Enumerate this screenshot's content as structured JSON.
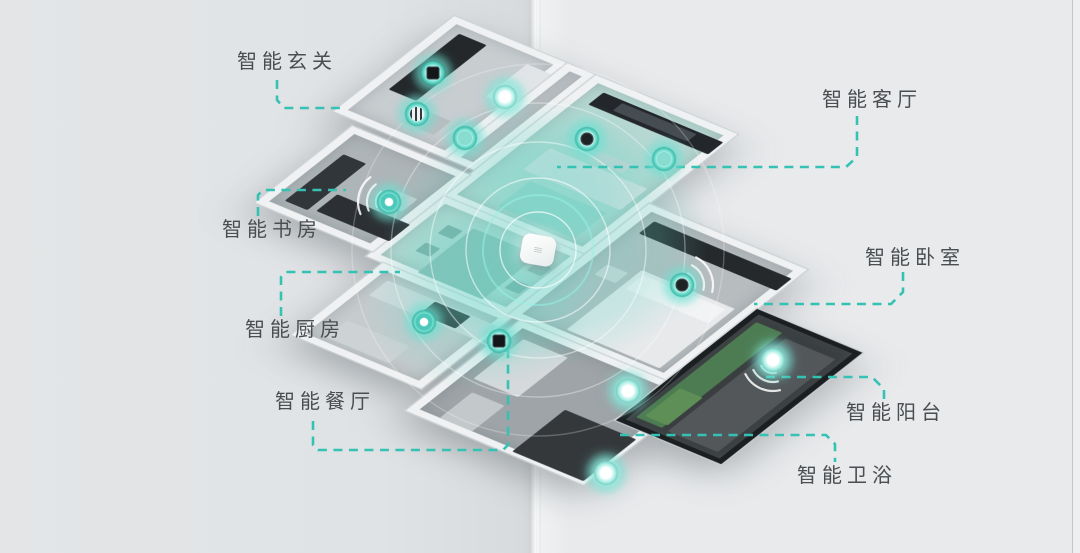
{
  "background": {
    "page_left_color": "#e0e3e5",
    "page_right_color": "#e8eaec",
    "fold_x": 537,
    "edge_line_x": 1072
  },
  "palette": {
    "leader_teal": "#35c2b4",
    "device_glow": "#6fdccd",
    "label_text": "#4a4e51",
    "wall": "#eff1f2"
  },
  "labels": [
    {
      "id": "entry",
      "text": "智能玄关",
      "x": 237,
      "y": 52
    },
    {
      "id": "study",
      "text": "智能书房",
      "x": 222,
      "y": 220
    },
    {
      "id": "kitchen",
      "text": "智能厨房",
      "x": 245,
      "y": 320
    },
    {
      "id": "dining",
      "text": "智能餐厅",
      "x": 275,
      "y": 392
    },
    {
      "id": "living",
      "text": "智能客厅",
      "x": 822,
      "y": 90
    },
    {
      "id": "bedroom",
      "text": "智能卧室",
      "x": 865,
      "y": 248
    },
    {
      "id": "balcony",
      "text": "智能阳台",
      "x": 846,
      "y": 403
    },
    {
      "id": "bathroom",
      "text": "智能卫浴",
      "x": 797,
      "y": 466
    }
  ],
  "leaders": [
    {
      "for": "entry",
      "points": [
        [
          277,
          80
        ],
        [
          277,
          100
        ],
        [
          284,
          108
        ],
        [
          342,
          108
        ]
      ]
    },
    {
      "for": "study",
      "points": [
        [
          258,
          216
        ],
        [
          258,
          195
        ],
        [
          263,
          190
        ],
        [
          346,
          190
        ]
      ]
    },
    {
      "for": "kitchen",
      "points": [
        [
          281,
          316
        ],
        [
          281,
          277
        ],
        [
          286,
          272
        ],
        [
          400,
          272
        ]
      ]
    },
    {
      "for": "dining",
      "points": [
        [
          313,
          421
        ],
        [
          313,
          445
        ],
        [
          318,
          450
        ],
        [
          503,
          450
        ],
        [
          508,
          445
        ],
        [
          508,
          346
        ]
      ]
    },
    {
      "for": "living",
      "points": [
        [
          857,
          116
        ],
        [
          857,
          157
        ],
        [
          846,
          167
        ],
        [
          557,
          167
        ]
      ]
    },
    {
      "for": "bedroom",
      "points": [
        [
          903,
          272
        ],
        [
          903,
          292
        ],
        [
          891,
          304
        ],
        [
          754,
          304
        ]
      ]
    },
    {
      "for": "balcony",
      "points": [
        [
          766,
          377
        ],
        [
          872,
          377
        ],
        [
          884,
          389
        ],
        [
          884,
          401
        ]
      ]
    },
    {
      "for": "bathroom",
      "points": [
        [
          620,
          435
        ],
        [
          826,
          435
        ],
        [
          835,
          444
        ],
        [
          835,
          462
        ]
      ]
    }
  ],
  "devices": [
    {
      "id": "entry-wall-panel",
      "x": 433,
      "y": 73,
      "variant": "panel"
    },
    {
      "id": "entry-ceiling-light",
      "x": 505,
      "y": 97,
      "variant": "bright"
    },
    {
      "id": "entry-controller",
      "x": 417,
      "y": 114,
      "variant": "striped"
    },
    {
      "id": "hallway-sensor",
      "x": 465,
      "y": 138,
      "variant": "teal"
    },
    {
      "id": "living-tv-device",
      "x": 587,
      "y": 139,
      "variant": "dark"
    },
    {
      "id": "living-wall-device",
      "x": 664,
      "y": 159,
      "variant": "teal"
    },
    {
      "id": "study-speaker",
      "x": 389,
      "y": 202,
      "variant": "ring"
    },
    {
      "id": "kitchen-sensor",
      "x": 424,
      "y": 322,
      "variant": "ring"
    },
    {
      "id": "dining-wall-panel",
      "x": 499,
      "y": 341,
      "variant": "panel"
    },
    {
      "id": "bedroom-speaker",
      "x": 682,
      "y": 285,
      "variant": "dark"
    },
    {
      "id": "bathroom-sensor-1",
      "x": 628,
      "y": 391,
      "variant": "bright"
    },
    {
      "id": "bathroom-sensor-2",
      "x": 606,
      "y": 473,
      "variant": "bright"
    },
    {
      "id": "balcony-sensor",
      "x": 773,
      "y": 360,
      "variant": "bright"
    }
  ],
  "hub": {
    "x": 538,
    "y": 250,
    "rings": [
      38,
      72,
      108,
      147,
      186
    ],
    "teal_ring": 55
  },
  "wifi": [
    {
      "at": "study",
      "x": 389,
      "y": 202,
      "dir": 195
    },
    {
      "at": "bedroom",
      "x": 682,
      "y": 285,
      "dir": 335
    },
    {
      "at": "balcony",
      "x": 773,
      "y": 360,
      "dir": 115
    }
  ],
  "glows": [
    {
      "x": 545,
      "y": 242,
      "rx": 210,
      "ry": 160,
      "o": 0.4
    },
    {
      "x": 478,
      "y": 300,
      "rx": 150,
      "ry": 115,
      "o": 0.28
    },
    {
      "x": 560,
      "y": 170,
      "rx": 120,
      "ry": 92,
      "o": 0.24
    }
  ],
  "floorplan": {
    "origin": {
      "left": 430,
      "top": 6
    },
    "rooms": [
      {
        "id": "entry",
        "x": 30,
        "y": 0,
        "w": 140,
        "h": 205,
        "floor": "#c8cdd0",
        "furniture": [
          [
            12,
            12,
            34,
            120,
            "#24282b"
          ],
          [
            98,
            15,
            52,
            70,
            "#e2e5e7"
          ],
          [
            55,
            140,
            40,
            30,
            "#b8bec1"
          ]
        ]
      },
      {
        "id": "hallway",
        "x": 170,
        "y": 0,
        "w": 35,
        "h": 205,
        "floor": "#c2c7ca",
        "furniture": []
      },
      {
        "id": "living",
        "x": 205,
        "y": 0,
        "w": 175,
        "h": 260,
        "floor": "#b7d8d2",
        "furniture": [
          [
            14,
            10,
            148,
            26,
            "#23272b"
          ],
          [
            40,
            14,
            92,
            16,
            "#454c52"
          ],
          [
            28,
            120,
            120,
            46,
            "#dde0e2"
          ],
          [
            45,
            178,
            95,
            55,
            "rgba(120,200,190,.38)"
          ],
          [
            70,
            95,
            42,
            18,
            "#cfd4d6"
          ]
        ]
      },
      {
        "id": "dining",
        "x": 205,
        "y": 260,
        "w": 175,
        "h": 130,
        "floor": "#b9d8d2",
        "furniture": [
          [
            48,
            18,
            80,
            95,
            "#8fbab3"
          ],
          [
            24,
            28,
            18,
            18,
            "#7fa9a3"
          ],
          [
            24,
            66,
            18,
            18,
            "#7fa9a3"
          ],
          [
            134,
            28,
            18,
            18,
            "#7fa9a3"
          ],
          [
            134,
            66,
            18,
            18,
            "#7fa9a3"
          ]
        ]
      },
      {
        "id": "study",
        "x": 60,
        "y": 215,
        "w": 145,
        "h": 165,
        "floor": "#aeb5b8",
        "furniture": [
          [
            12,
            35,
            28,
            100,
            "#31363a"
          ],
          [
            48,
            95,
            90,
            36,
            "#2c3034"
          ],
          [
            92,
            55,
            26,
            26,
            "#c9ced1"
          ]
        ]
      },
      {
        "id": "kitchen",
        "x": 225,
        "y": 390,
        "w": 160,
        "h": 155,
        "floor": "#c6cbcd",
        "furniture": [
          [
            12,
            12,
            135,
            32,
            "#d6dadc"
          ],
          [
            72,
            14,
            44,
            26,
            "#2a2e31"
          ],
          [
            20,
            92,
            78,
            36,
            "#cdd2d4"
          ]
        ]
      },
      {
        "id": "bedroom",
        "x": 380,
        "y": 150,
        "w": 195,
        "h": 240,
        "floor": "#b7bcbf",
        "furniture": [
          [
            12,
            12,
            170,
            26,
            "#26292c"
          ],
          [
            52,
            88,
            115,
            128,
            "#e7e9eb"
          ],
          [
            58,
            94,
            102,
            30,
            "#f2f3f4"
          ],
          [
            18,
            100,
            26,
            22,
            "#d2d6d8"
          ]
        ]
      },
      {
        "id": "bathroom",
        "x": 395,
        "y": 390,
        "w": 220,
        "h": 195,
        "floor": "#9ea4a7",
        "furniture": [
          [
            12,
            15,
            55,
            85,
            "#d6d9db"
          ],
          [
            118,
            90,
            88,
            90,
            "#34383b"
          ],
          [
            25,
            120,
            40,
            55,
            "#c3c8ca"
          ]
        ]
      },
      {
        "id": "balcony",
        "x": 575,
        "y": 235,
        "w": 130,
        "h": 240,
        "floor": "#3a3e40",
        "frame": "dark",
        "furniture": [
          [
            6,
            12,
            32,
            205,
            "#4d7c52"
          ],
          [
            46,
            18,
            62,
            200,
            "#53575a"
          ],
          [
            12,
            150,
            28,
            60,
            "#5d8f56"
          ]
        ]
      }
    ]
  }
}
